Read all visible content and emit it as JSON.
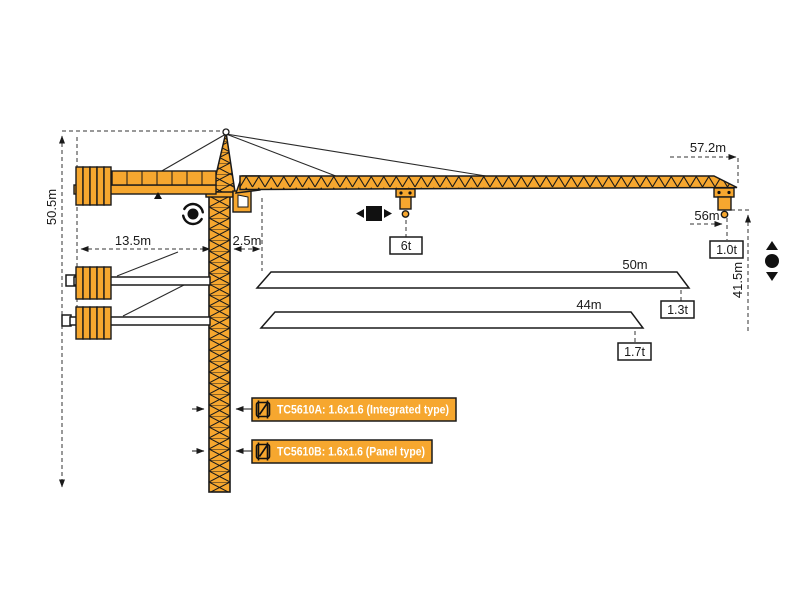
{
  "diagram": {
    "type": "tower-crane-specification-diagram",
    "colors": {
      "crane_orange": "#F6A72F",
      "outline": "#1A1A1A",
      "label_text": "#FFFFFF",
      "background": "#FFFFFF"
    },
    "dimensions": {
      "total_height": "50.5m",
      "counter_jib_radius": "13.5m",
      "rear_offset": "2.5m",
      "max_working_radius": "57.2m",
      "tip_radius": "56m",
      "hook_height": "41.5m"
    },
    "loads": {
      "max_load": "6t",
      "tip_load_main": "1.0t",
      "tip_load_50m": "1.3t",
      "tip_load_44m": "1.7t"
    },
    "jib_variants": {
      "jib_50": "50m",
      "jib_44": "44m"
    },
    "mast_sections": [
      {
        "label": "TC5610A: 1.6x1.6 (Integrated type)"
      },
      {
        "label": "TC5610B: 1.6x1.6 (Panel type)"
      }
    ]
  }
}
